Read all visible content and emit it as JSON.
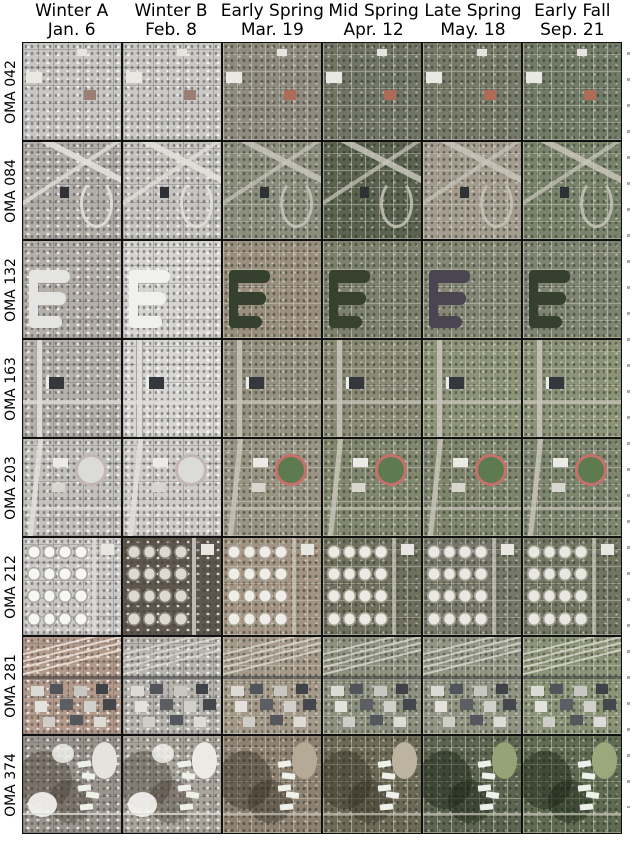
{
  "figure": {
    "columns": [
      {
        "season": "Winter A",
        "date": "Jan. 6"
      },
      {
        "season": "Winter B",
        "date": "Feb. 8"
      },
      {
        "season": "Early Spring",
        "date": "Mar. 19"
      },
      {
        "season": "Mid Spring",
        "date": "Apr. 12"
      },
      {
        "season": "Late Spring",
        "date": "May. 18"
      },
      {
        "season": "Early Fall",
        "date": "Sep. 21"
      }
    ],
    "rows": [
      {
        "label": "OMA 042",
        "feature": "residential-grid",
        "tile_colors": [
          "#c9c7c3",
          "#cbc9c5",
          "#8f8b7e",
          "#717565",
          "#777a69",
          "#717b67"
        ]
      },
      {
        "label": "OMA 084",
        "feature": "highway-interchange",
        "tile_colors": [
          "#b2aea8",
          "#c7c5c0",
          "#8b8d7d",
          "#5b624f",
          "#a49c8f",
          "#79836b"
        ]
      },
      {
        "label": "OMA 132",
        "feature": "lake-subdivision",
        "tile_colors": [
          "#b4afa8",
          "#d7d5d1",
          "#9a8f7e",
          "#7d806d",
          "#848774",
          "#7e8471"
        ]
      },
      {
        "label": "OMA 163",
        "feature": "vertical-highway",
        "tile_colors": [
          "#b5b1aa",
          "#d9d7d3",
          "#969180",
          "#8a8a77",
          "#8e9479",
          "#8c9378"
        ]
      },
      {
        "label": "OMA 203",
        "feature": "campus-track",
        "tile_colors": [
          "#c4c2bd",
          "#d0ceca",
          "#9a9484",
          "#82886f",
          "#80866e",
          "#7e8670"
        ]
      },
      {
        "label": "OMA 212",
        "feature": "tank-farm",
        "tile_colors": [
          "#ccc9c6",
          "#5f574b",
          "#a29382",
          "#6f715e",
          "#77786a",
          "#717662"
        ]
      },
      {
        "label": "OMA 281",
        "feature": "railyard",
        "tile_colors": [
          "#b49a8a",
          "#b8b5ae",
          "#a59a8a",
          "#8f9180",
          "#939584",
          "#8b9378"
        ]
      },
      {
        "label": "OMA 374",
        "feature": "forest-pond",
        "tile_colors": [
          "#9b948c",
          "#aaa49b",
          "#8d8172",
          "#6e6a58",
          "#5d6550",
          "#606c52"
        ]
      }
    ],
    "feature_palette": {
      "lake": [
        "#e4e4e2",
        "#f0f0ee",
        "#35402f",
        "#37412e",
        "#4a4550",
        "#36402f"
      ],
      "track_ring_winter": "#c3b6b4",
      "track_ring": "#c5706a",
      "track_field_winter": "#dbdcd8",
      "track_field": "#5e7a4f",
      "tank_fill": [
        "#f6f6f4",
        "#ded9d0",
        "#f0ede6",
        "#eceae2",
        "#e9e8e2",
        "#e9e8e0"
      ],
      "clearing": [
        "#e6e3dd",
        "#eceae5",
        "#b5aa95",
        "#bdb4a0",
        "#95a377",
        "#9aa87c"
      ],
      "red_building": "#b06a58",
      "dark_building": "#34383d",
      "white_building": "#eceae6"
    }
  }
}
